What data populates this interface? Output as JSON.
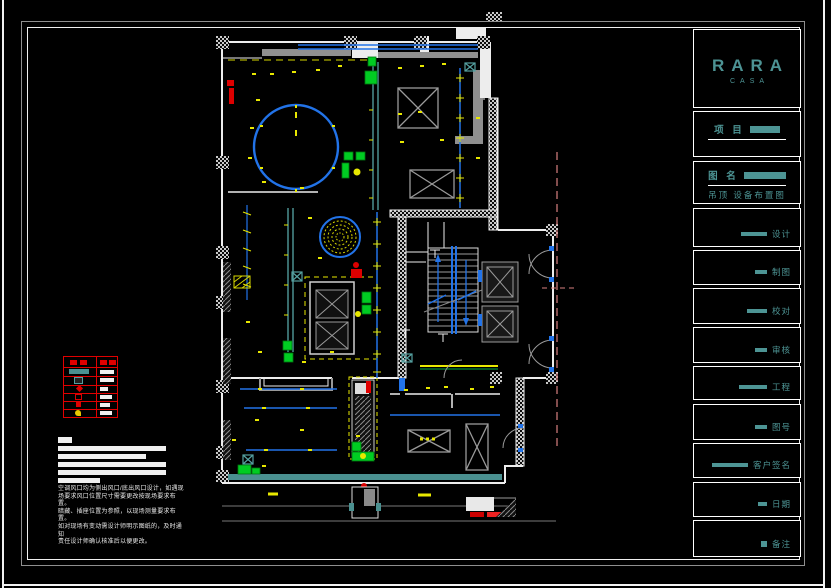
{
  "title_block": {
    "logo": {
      "brand": "RARA",
      "sub": "CASA"
    },
    "project": {
      "label": "项 目"
    },
    "drawing": {
      "label": "图 名",
      "name": "吊顶  设备布置图"
    },
    "rows": [
      {
        "label": "设计"
      },
      {
        "label": "制图"
      },
      {
        "label": "校对"
      },
      {
        "label": "审核"
      },
      {
        "label": "工程"
      },
      {
        "label": "图号"
      },
      {
        "label": "客户签名"
      },
      {
        "label": "日期"
      },
      {
        "label": "备注"
      }
    ]
  },
  "notes": {
    "lines": [
      "空调风口均为侧出风口/底出风口设计，如遇现",
      "场要求风口位置尺寸需要更改按现场要求布置。",
      "暗藏、插座位置为参照，以现场测量要求布置。",
      "如对现场有变动需设计师明示图纸的，及时通知",
      "责任设计师确认核准后以便更改。"
    ]
  },
  "colors": {
    "accent_teal": "#4d9494",
    "wall_white": "#ededed",
    "ceiling_blue": "#2273e8",
    "partition_teal": "#4a9090",
    "light_yellow": "#e8e800",
    "equipment_green": "#00cc22",
    "alert_red": "#dd0000",
    "ref_pink": "#d98080",
    "legend_red": "#e00000"
  }
}
